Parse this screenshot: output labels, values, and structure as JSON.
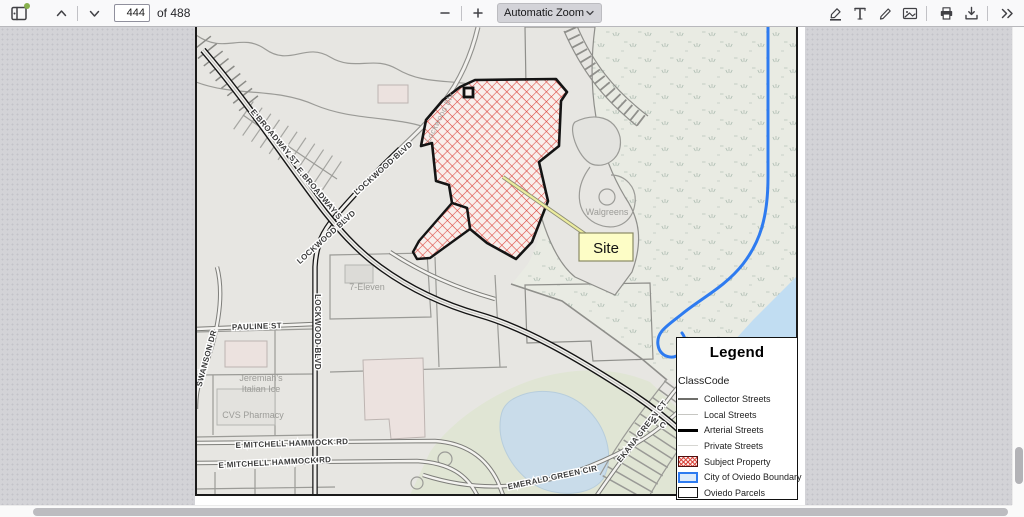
{
  "toolbar": {
    "page_input": "444",
    "page_count_label": "of 488",
    "zoom_select_label": "Automatic Zoom"
  },
  "map": {
    "street_labels": {
      "broadway": "E BROADWAY ST",
      "lockwood": "LOCKWOOD BLVD",
      "pauline": "PAULINE ST",
      "swanson": "SWANSON DR",
      "mitchell": "E MITCHELL HAMMOCK RD",
      "emerald": "EMERALD GREEN CIR",
      "ekana": "EKANA GREEN CT",
      "w_partial": "W C"
    },
    "poi_labels": {
      "walgreens": "Walgreens",
      "seven_eleven": "7-Eleven",
      "jeremiahs_1": "Jeremiah's",
      "jeremiahs_2": "Italian Ice",
      "cvs": "CVS Pharmacy",
      "lockwood_inline": "Lockwood Blv"
    },
    "site_callout": "Site",
    "colors": {
      "subject_hatch": "#dd4840",
      "boundary_blue": "#2e7bf0",
      "water": "#c9dcea",
      "field_green": "#e0e5d4"
    }
  },
  "legend": {
    "title": "Legend",
    "subtitle": "ClassCode",
    "items": [
      {
        "label": "Collector Streets"
      },
      {
        "label": "Local Streets"
      },
      {
        "label": "Arterial Streets"
      },
      {
        "label": "Private Streets"
      },
      {
        "label": "Subject Property"
      },
      {
        "label": "City of Oviedo Boundary"
      },
      {
        "label": "Oviedo Parcels"
      }
    ]
  }
}
